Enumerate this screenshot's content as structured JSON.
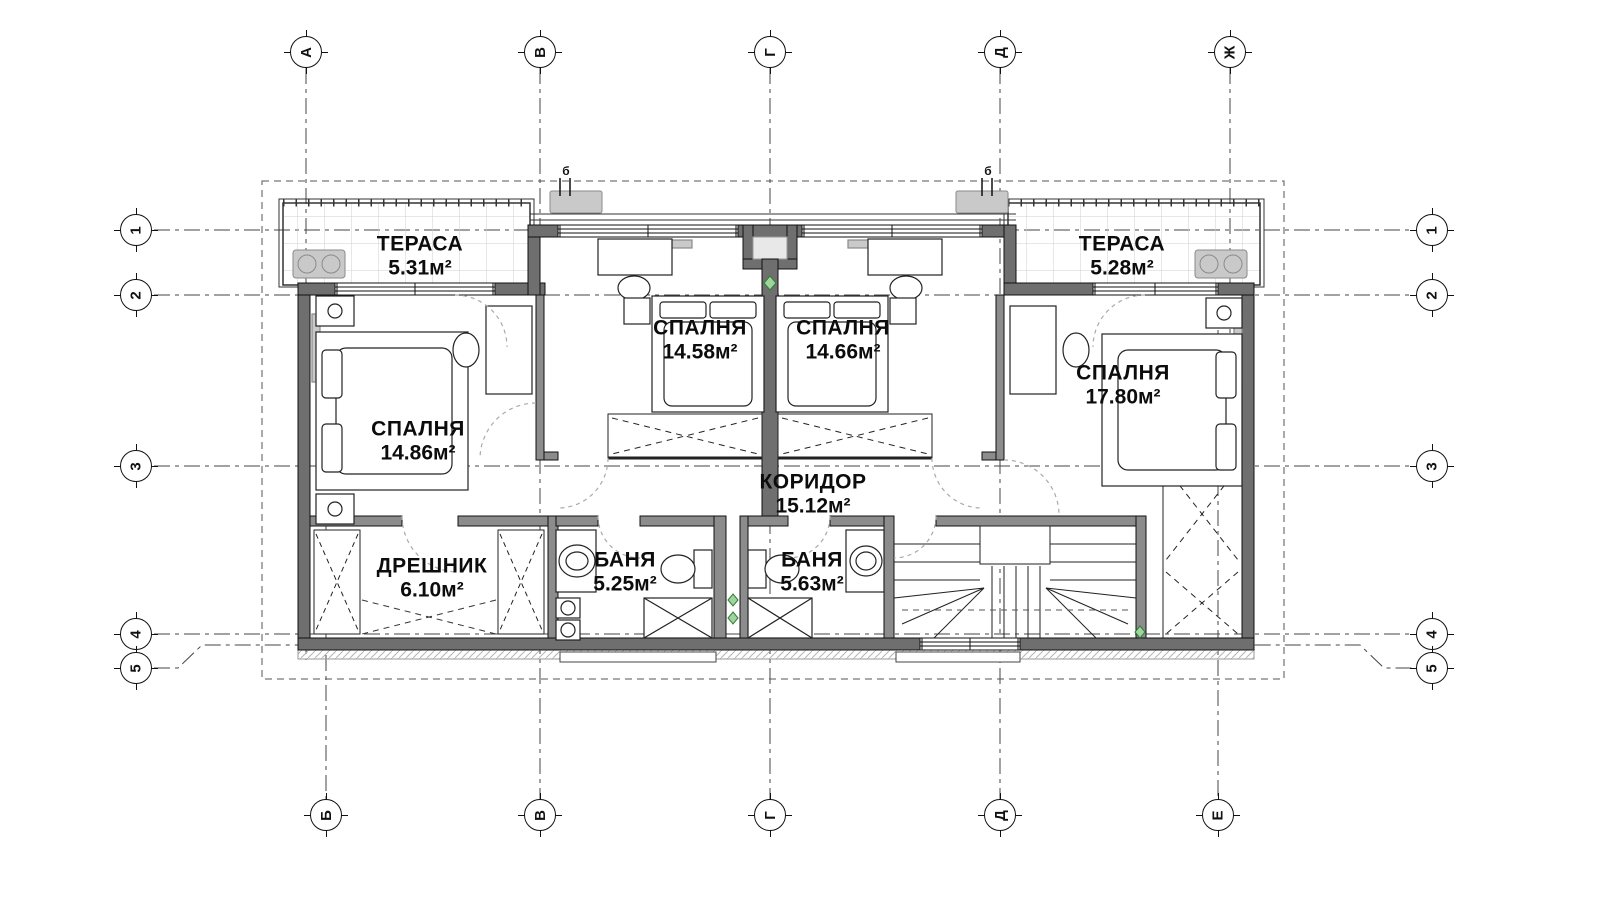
{
  "rooms": [
    {
      "name": "ТЕРАСА",
      "area": "5.31м²",
      "x": 420,
      "y": 256
    },
    {
      "name": "ТЕРАСА",
      "area": "5.28м²",
      "x": 1122,
      "y": 256
    },
    {
      "name": "СПАЛНЯ",
      "area": "14.58м²",
      "x": 700,
      "y": 340
    },
    {
      "name": "СПАЛНЯ",
      "area": "14.66м²",
      "x": 843,
      "y": 340
    },
    {
      "name": "СПАЛНЯ",
      "area": "14.86м²",
      "x": 418,
      "y": 441
    },
    {
      "name": "СПАЛНЯ",
      "area": "17.80м²",
      "x": 1123,
      "y": 385
    },
    {
      "name": "КОРИДОР",
      "area": "15.12м²",
      "x": 813,
      "y": 494
    },
    {
      "name": "ДРЕШНИК",
      "area": "6.10м²",
      "x": 432,
      "y": 578
    },
    {
      "name": "БАНЯ",
      "area": "5.25м²",
      "x": 625,
      "y": 572
    },
    {
      "name": "БАНЯ",
      "area": "5.63м²",
      "x": 812,
      "y": 572
    }
  ],
  "axes": {
    "top": [
      {
        "label": "А",
        "x": 306
      },
      {
        "label": "В",
        "x": 540
      },
      {
        "label": "Г",
        "x": 770
      },
      {
        "label": "Д",
        "x": 1000
      },
      {
        "label": "Ж",
        "x": 1230
      }
    ],
    "bottom": [
      {
        "label": "Б",
        "x": 326
      },
      {
        "label": "В",
        "x": 540
      },
      {
        "label": "Г",
        "x": 770
      },
      {
        "label": "Д",
        "x": 1000
      },
      {
        "label": "Е",
        "x": 1218
      }
    ],
    "left": [
      {
        "label": "1",
        "y": 230
      },
      {
        "label": "2",
        "y": 295
      },
      {
        "label": "3",
        "y": 466
      },
      {
        "label": "4",
        "y": 634
      },
      {
        "label": "5",
        "y": 668
      }
    ],
    "right": [
      {
        "label": "1",
        "y": 230
      },
      {
        "label": "2",
        "y": 295
      },
      {
        "label": "3",
        "y": 466
      },
      {
        "label": "4",
        "y": 634
      },
      {
        "label": "5",
        "y": 668
      }
    ]
  },
  "section_markers": [
    {
      "label": "б",
      "x": 566,
      "y": 171
    },
    {
      "label": "б",
      "x": 988,
      "y": 171
    }
  ],
  "colors": {
    "wall_exterior": "#6f6f6f",
    "wall_interior": "#8c8c8c",
    "line": "#1a1a1a",
    "furniture_gray": "#c9c9c9",
    "marker_green": "#2f7d32"
  }
}
